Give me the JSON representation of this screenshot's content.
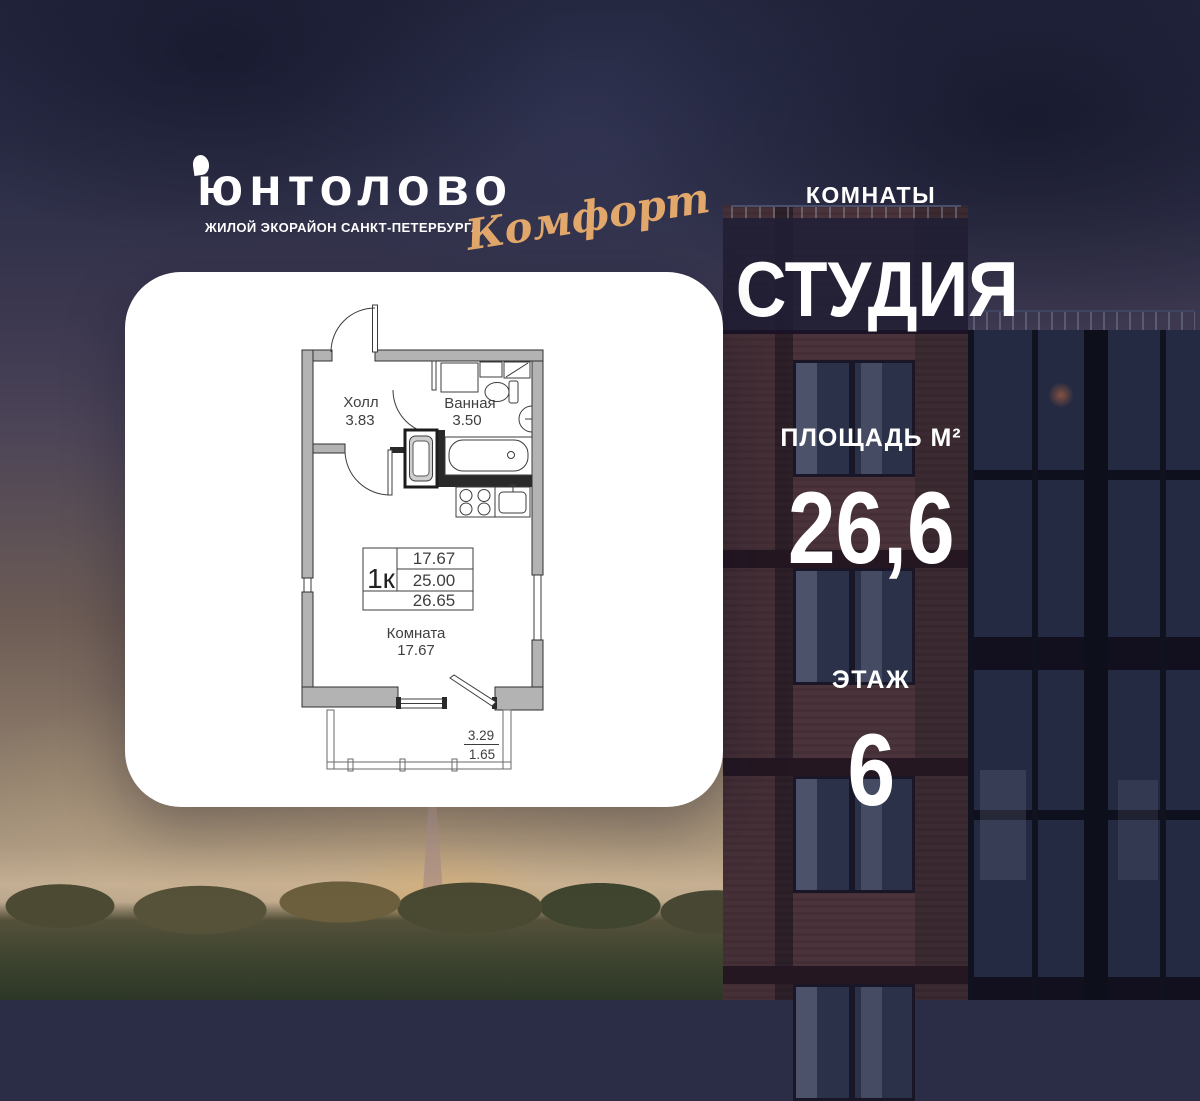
{
  "logo": {
    "brand": "юнтолово",
    "tagline": "ЖИЛОЙ ЭКОРАЙОН САНКТ-ПЕТЕРБУРГА",
    "edition": "Комфорт"
  },
  "listing": {
    "rooms_label": "КОМНАТЫ",
    "rooms_value": "СТУДИЯ",
    "area_label": "ПЛОЩАДЬ М²",
    "area_value": "26,6",
    "floor_label": "ЭТАЖ",
    "floor_value": "6"
  },
  "floorplan": {
    "hall_label": "Холл",
    "hall_area": "3.83",
    "bath_label": "Ванная",
    "bath_area": "3.50",
    "room_label": "Комната",
    "room_area": "17.67",
    "unit_type": "1к",
    "area_living": "17.67",
    "area_main": "25.00",
    "area_total": "26.65",
    "balcony_top": "3.29",
    "balcony_bottom": "1.65"
  },
  "colors": {
    "accent_gold": "#e2a86b",
    "card_bg": "#ffffff"
  }
}
